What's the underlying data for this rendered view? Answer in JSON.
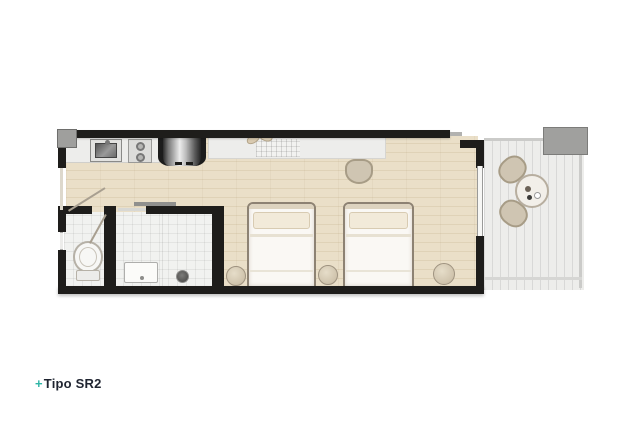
{
  "title": {
    "prefix": "+",
    "name": "Tipo SR2"
  },
  "colors": {
    "accent": "#2fb5a6",
    "title_text": "#1f2430",
    "wall": "#1e1d1b",
    "wood_floor": "#eadfc8",
    "tile_floor": "#f1f2f0",
    "balcony_floor": "#ededeb",
    "counter": "#ededeb",
    "furniture_beige": "#cfc5b2",
    "furniture_border": "#a79c86",
    "bed_linen": "#faf8f4",
    "pillow": "#f2ead9",
    "shaft_gray": "#9f9f9d",
    "planter_gray": "#a0a09e"
  },
  "floorplan": {
    "unit_label": "Tipo SR2",
    "rooms": [
      "kitchenette",
      "hall",
      "wc",
      "bathroom",
      "bedroom",
      "balcony"
    ],
    "furniture": [
      "kitchen-sink",
      "cooktop",
      "refrigerator",
      "kitchen-counter",
      "counter-desk",
      "dish-rack",
      "plant-decor",
      "desk-chair",
      "toilet",
      "bathroom-vanity",
      "shower-drain",
      "double-bed",
      "double-bed",
      "pouf",
      "pouf",
      "pouf",
      "balcony-table",
      "balcony-chair",
      "balcony-chair",
      "sliding-glass-door",
      "entry-door",
      "planter-box"
    ]
  }
}
